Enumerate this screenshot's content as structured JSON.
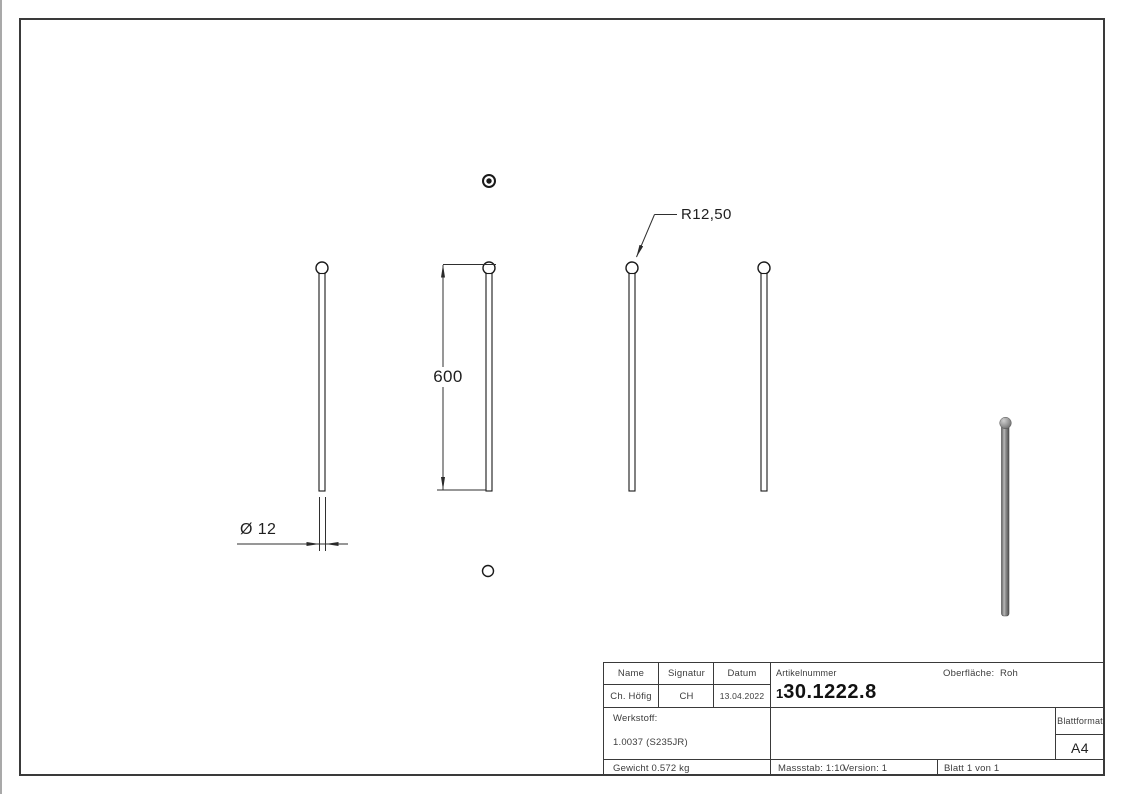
{
  "drawing_view": {
    "radius_dim": "R12,50",
    "length_dim": "600",
    "diameter_dim": "Ø 12"
  },
  "title_block": {
    "headers": {
      "name": "Name",
      "signatur": "Signatur",
      "datum": "Datum"
    },
    "values": {
      "name": "Ch. Höfig",
      "signatur": "CH",
      "datum": "13.04.2022"
    },
    "artikelnummer": {
      "label": "Artikelnummer",
      "prefix": "1",
      "number": "30.1222.8",
      "full": "130.1222.8"
    },
    "oberflaeche": {
      "label": "Oberfläche:",
      "value": "Roh"
    },
    "werkstoff": {
      "label": "Werkstoff:",
      "value": "1.0037 (S235JR)"
    },
    "blattformat": {
      "label": "Blattformat",
      "value": "A4"
    },
    "gewicht": "Gewicht 0.572 kg",
    "massstab": "Massstab: 1:10",
    "version": "Version: 1",
    "blatt": "Blatt 1 von 1"
  },
  "colors": {
    "line": "#3a3a3a",
    "geometry": "#1a1a1a",
    "rod_shaded": "#8a8a8a"
  }
}
